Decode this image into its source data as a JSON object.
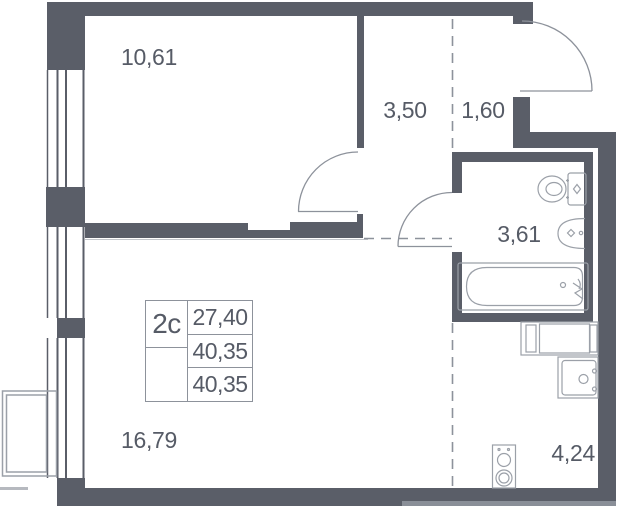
{
  "colors": {
    "wall": "#5a5e68",
    "furniture": "#9ba0a8",
    "dash": "#8d929b",
    "text": "#565b66",
    "table-line": "#8d929b"
  },
  "rooms": {
    "bedroom": {
      "area": "10,61"
    },
    "hall": {
      "area": "3,50"
    },
    "entry": {
      "area": "1,60"
    },
    "bathroom": {
      "area": "3,61"
    },
    "living": {
      "area": "16,79"
    },
    "kitchen": {
      "area": "4,24"
    }
  },
  "info_box": {
    "type_label": "2с",
    "living_area": "27,40",
    "area": "40,35",
    "total_area": "40,35"
  },
  "symbols": [
    "window-symbol",
    "balcony-symbol",
    "door-arc-entrance",
    "door-arc-bedroom",
    "door-arc-bathroom",
    "toilet-symbol",
    "washbasin-symbol",
    "bathtub-symbol",
    "kitchen-counter-symbol",
    "kitchen-sink-symbol",
    "stove-symbol"
  ]
}
